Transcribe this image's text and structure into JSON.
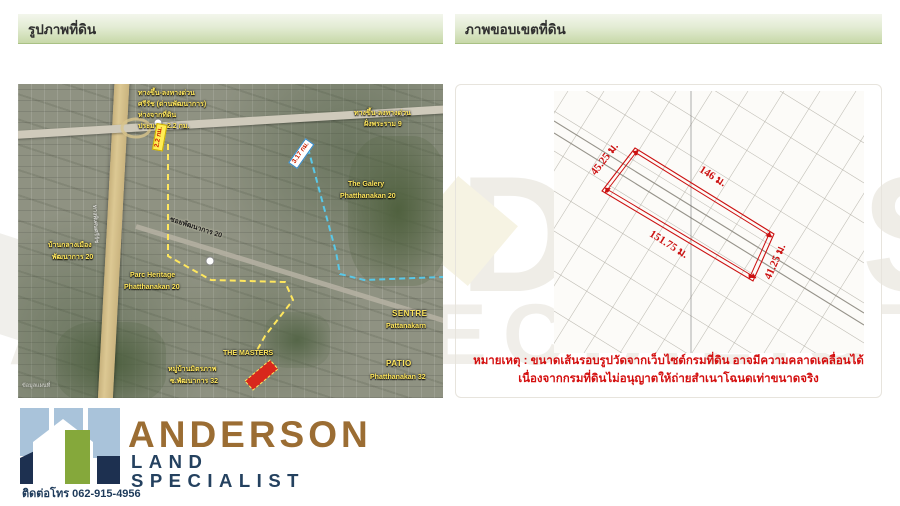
{
  "headers": {
    "left": "รูปภาพที่ดิน",
    "right": "ภาพขอบเขตที่ดิน"
  },
  "watermark": {
    "line1": "ANDERSON",
    "line2": "LAND SPECIALIST"
  },
  "map": {
    "labels": {
      "exit_block_1": "ทางขึ้น-ลงทางด่วน",
      "exit_block_2": "ศรีรัช (ด่านพัฒนาการ)",
      "exit_block_3": "ห่างจากที่ดิน",
      "exit_block_4": "ประมาณ 2.2 กม.",
      "ramp_right_1": "ทางขึ้น-ลงทางด่วน",
      "ramp_right_2": "ฝั่งพระราม 9",
      "galery_1": "The Galery",
      "galery_2": "Phatthanakan 20",
      "baan_1": "บ้านกลางเมือง",
      "baan_2": "พัฒนาการ 20",
      "parc_1": "Parc Heritage",
      "parc_2": "Phatthanakan 20",
      "soi_road": "ซอยพัฒนาการ 20",
      "sentre_1": "SENTRE",
      "sentre_2": "Pattanakarn",
      "patio_1": "PATIO",
      "patio_2": "Phatthanakan 32",
      "masters": "THE MASTERS",
      "village_1": "หมู่บ้านมิตรภาพ",
      "village_2": "ซ.พัฒนาการ 32",
      "expressway": "ทางพิเศษศรีรัช",
      "credit": "ข้อมูลแผนที่"
    },
    "badges": {
      "yellow_distance": "2.2 กม.",
      "blue_distance": "3.17 กม."
    }
  },
  "survey": {
    "dimensions": {
      "left": "45.25 ม.",
      "top": "146 ม.",
      "right": "41.25 ม.",
      "bottom": "151.75 ม."
    },
    "note_line1": "หมายเหตุ : ขนาดเส้นรอบรูปวัดจากเว็บไซต์กรมที่ดิน อาจมีความคลาดเคลื่อนได้",
    "note_line2": "เนื่องจากกรมที่ดินไม่อนุญาตให้ถ่ายสำเนาโฉนดเท่าขนาดจริง"
  },
  "logo": {
    "name": "ANDERSON",
    "subtitle": "LAND SPECIALIST",
    "phone": "ติดต่อโทร 062-915-4956"
  },
  "colors": {
    "header_green": "#c7d8a8",
    "logo_brown": "#9b6d33",
    "logo_navy": "#24415f",
    "logo_green": "#85a83b",
    "logo_blue": "#a9c3da",
    "note_red": "#d40f0f",
    "dimension_red": "#cc1111",
    "route_yellow": "#ffe75e",
    "route_cyan": "#59c8e8",
    "parcel_red": "#d8281c",
    "watermark_gray": "#efede7"
  }
}
